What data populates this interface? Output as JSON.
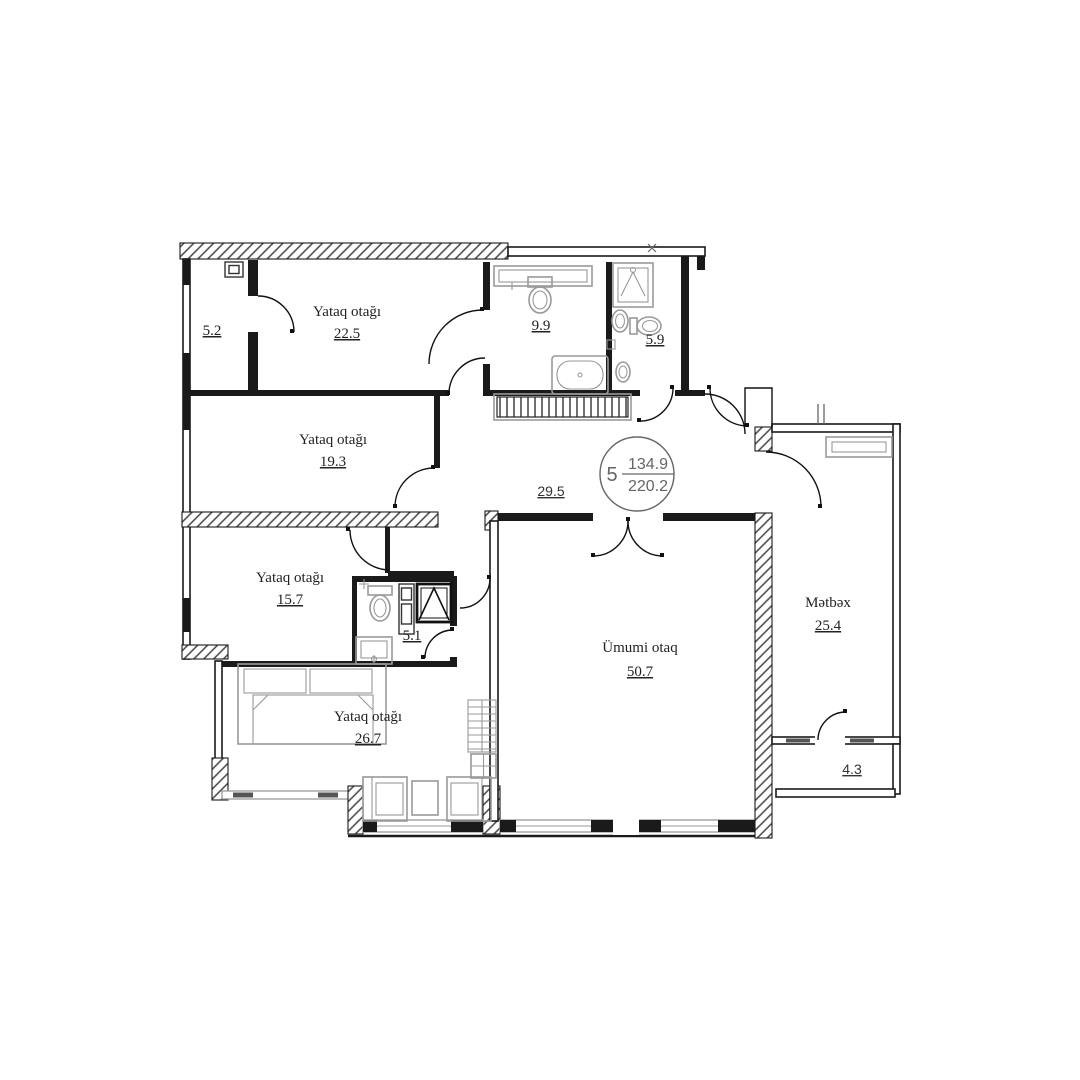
{
  "unit": {
    "number": "5",
    "upper_area": "134.9",
    "lower_area": "220.2"
  },
  "rooms": {
    "wardrobe": {
      "area": "5.2"
    },
    "bedroom1": {
      "label": "Yataq otağı",
      "area": "22.5"
    },
    "bath": {
      "area": "9.9"
    },
    "wc": {
      "area": "5.9"
    },
    "hall": {
      "area": "29.5"
    },
    "bedroom2": {
      "label": "Yataq otağı",
      "area": "19.3"
    },
    "bedroom3": {
      "label": "Yataq otağı",
      "area": "15.7"
    },
    "shower_room": {
      "area": "5.1"
    },
    "bedroom4": {
      "label": "Yataq otağı",
      "area": "26.7"
    },
    "living": {
      "label": "Ümumi otaq",
      "area": "50.7"
    },
    "kitchen": {
      "label": "Mətbəx",
      "area": "25.4"
    },
    "balcony": {
      "area": "4.3"
    }
  },
  "colors": {
    "wall": "#1a1a1a",
    "fixtures": "#999999",
    "hatch": "#444444",
    "label_text": "#222222",
    "unit_text": "#666666"
  }
}
